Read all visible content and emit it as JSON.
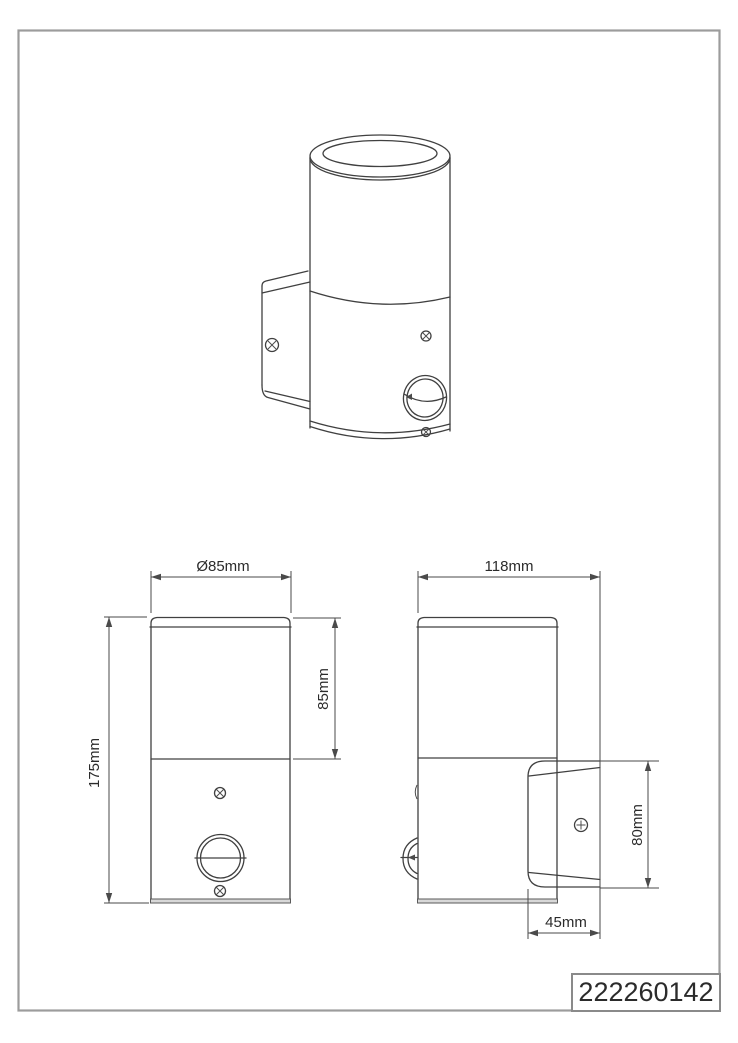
{
  "page": {
    "background_color": "#ffffff",
    "border_color": "#9c9c9c",
    "line_color": "#404040",
    "text_color": "#2b2b2b"
  },
  "title_block": {
    "part_number": "222260142"
  },
  "dimensions": {
    "front_view": {
      "diameter_label": "Ø85mm",
      "upper_section_height_label": "85mm",
      "total_height_label": "175mm"
    },
    "side_view": {
      "total_depth_label": "118mm",
      "bracket_height_label": "80mm",
      "bracket_depth_label": "45mm"
    }
  }
}
